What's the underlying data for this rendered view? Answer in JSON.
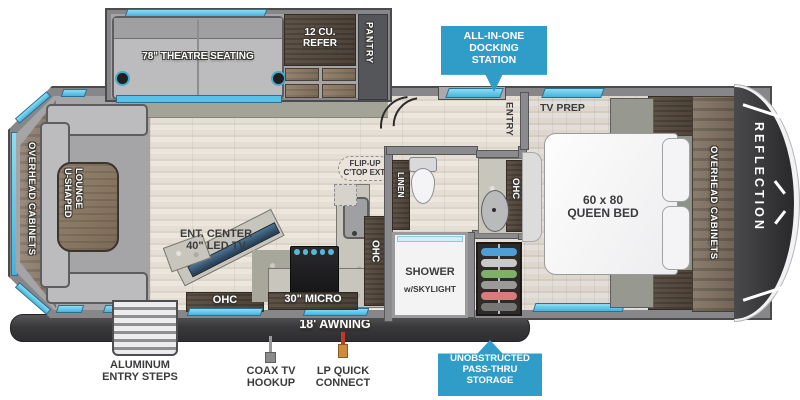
{
  "slideout": {
    "theatre": "78\" THEATRE SEATING",
    "refer_l1": "12 CU.",
    "refer_l2": "REFER",
    "pantry": "PANTRY"
  },
  "living": {
    "overhead_cabinets": "OVERHEAD CABINETS",
    "lounge_l1": "U-SHAPED",
    "lounge_l2": "LOUNGE",
    "ent_l1": "ENT. CENTER",
    "ent_l2": "40\" LED TV",
    "ohc": "OHC"
  },
  "kitchen": {
    "flip_l1": "FLIP-UP",
    "flip_l2": "C'TOP EXT.",
    "ohc": "OHC",
    "micro": "30\" MICRO"
  },
  "bath": {
    "linen": "LINEN",
    "ohc": "OHC",
    "shower_l1": "SHOWER",
    "shower_l2": "w/SKYLIGHT"
  },
  "bedroom": {
    "entry": "ENTRY",
    "tv_prep": "TV PREP",
    "bed_l1": "60 x 80",
    "bed_l2": "QUEEN BED",
    "overhead_cabinets": "OVERHEAD CABINETS",
    "brand": "REFLECTION"
  },
  "badges": {
    "docking_l1": "ALL-IN-ONE",
    "docking_l2": "DOCKING",
    "docking_l3": "STATION",
    "passthru_l1": "UNOBSTRUCTED",
    "passthru_l2": "PASS-THRU",
    "passthru_l3": "STORAGE"
  },
  "exterior": {
    "awning": "18' AWNING",
    "steps_l1": "ALUMINUM",
    "steps_l2": "ENTRY STEPS",
    "coax_l1": "COAX TV",
    "coax_l2": "HOOKUP",
    "lp_l1": "LP QUICK",
    "lp_l2": "CONNECT"
  },
  "colors": {
    "badge_blue": "#2f9dc8",
    "window_blue": "#5ec7e8",
    "wall_gray": "#87878a",
    "awning_dark": "#3f3f41",
    "dark_wood": "#554a3f",
    "front_cap": "#3b3b3d"
  }
}
